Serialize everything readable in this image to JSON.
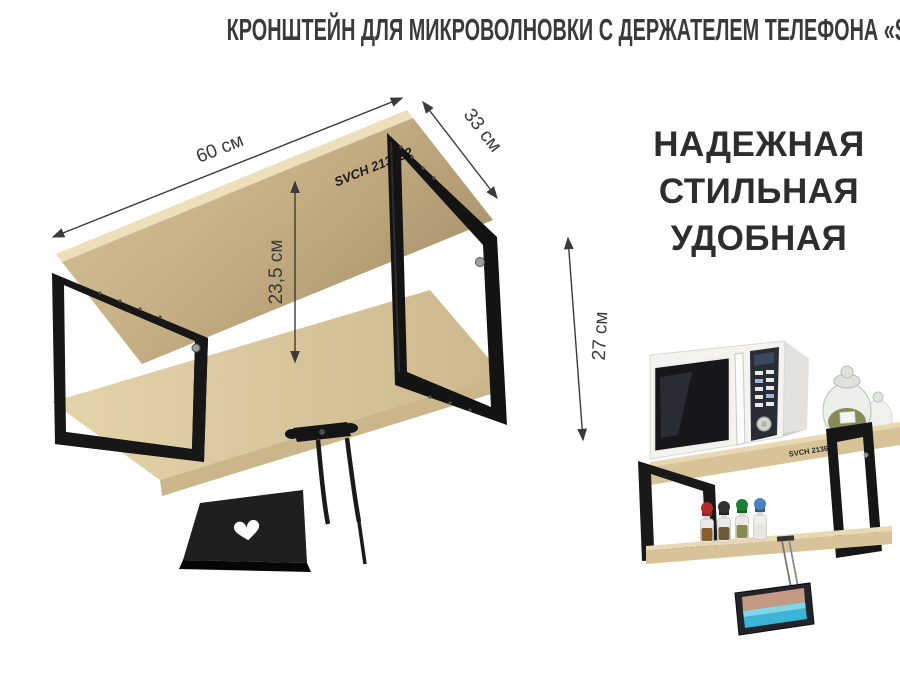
{
  "title": {
    "text": "КРОНШТЕЙН ДЛЯ МИКРОВОЛНОВКИ С ДЕРЖАТЕЛЕМ ТЕЛЕФОНА «SVCH 213692»"
  },
  "slogan": {
    "lines": [
      "НАДЕЖНАЯ",
      "СТИЛЬНАЯ",
      "УДОБНАЯ"
    ]
  },
  "diagram": {
    "brand_label": "SVCH 213692",
    "dimensions": {
      "length": "60 см",
      "depth": "33 см",
      "inner_height": "23,5 см",
      "total_height": "27 см"
    }
  },
  "photo": {
    "shelf_label": "SVCH 213692",
    "items": [
      "microwave",
      "glass-jar",
      "spice-bottles",
      "smartphone-in-holder"
    ],
    "spice_cap_colors": [
      "#b52c26",
      "#323232",
      "#1e7d35",
      "#4a7fc0"
    ],
    "phone_screen": {
      "shore": "#c49a84",
      "sea": "#3cb4d6"
    }
  },
  "colors": {
    "background": "#ffffff",
    "title_text": "#3a3a3a",
    "slogan_text": "#2d2d2d",
    "dimension_lines": "#3a3a3a",
    "wood": "#d3bf94",
    "wood_light": "#e9dcb8",
    "metal": "#171717",
    "microwave_body": "#f4f3ef",
    "microwave_window": "#16161b"
  }
}
